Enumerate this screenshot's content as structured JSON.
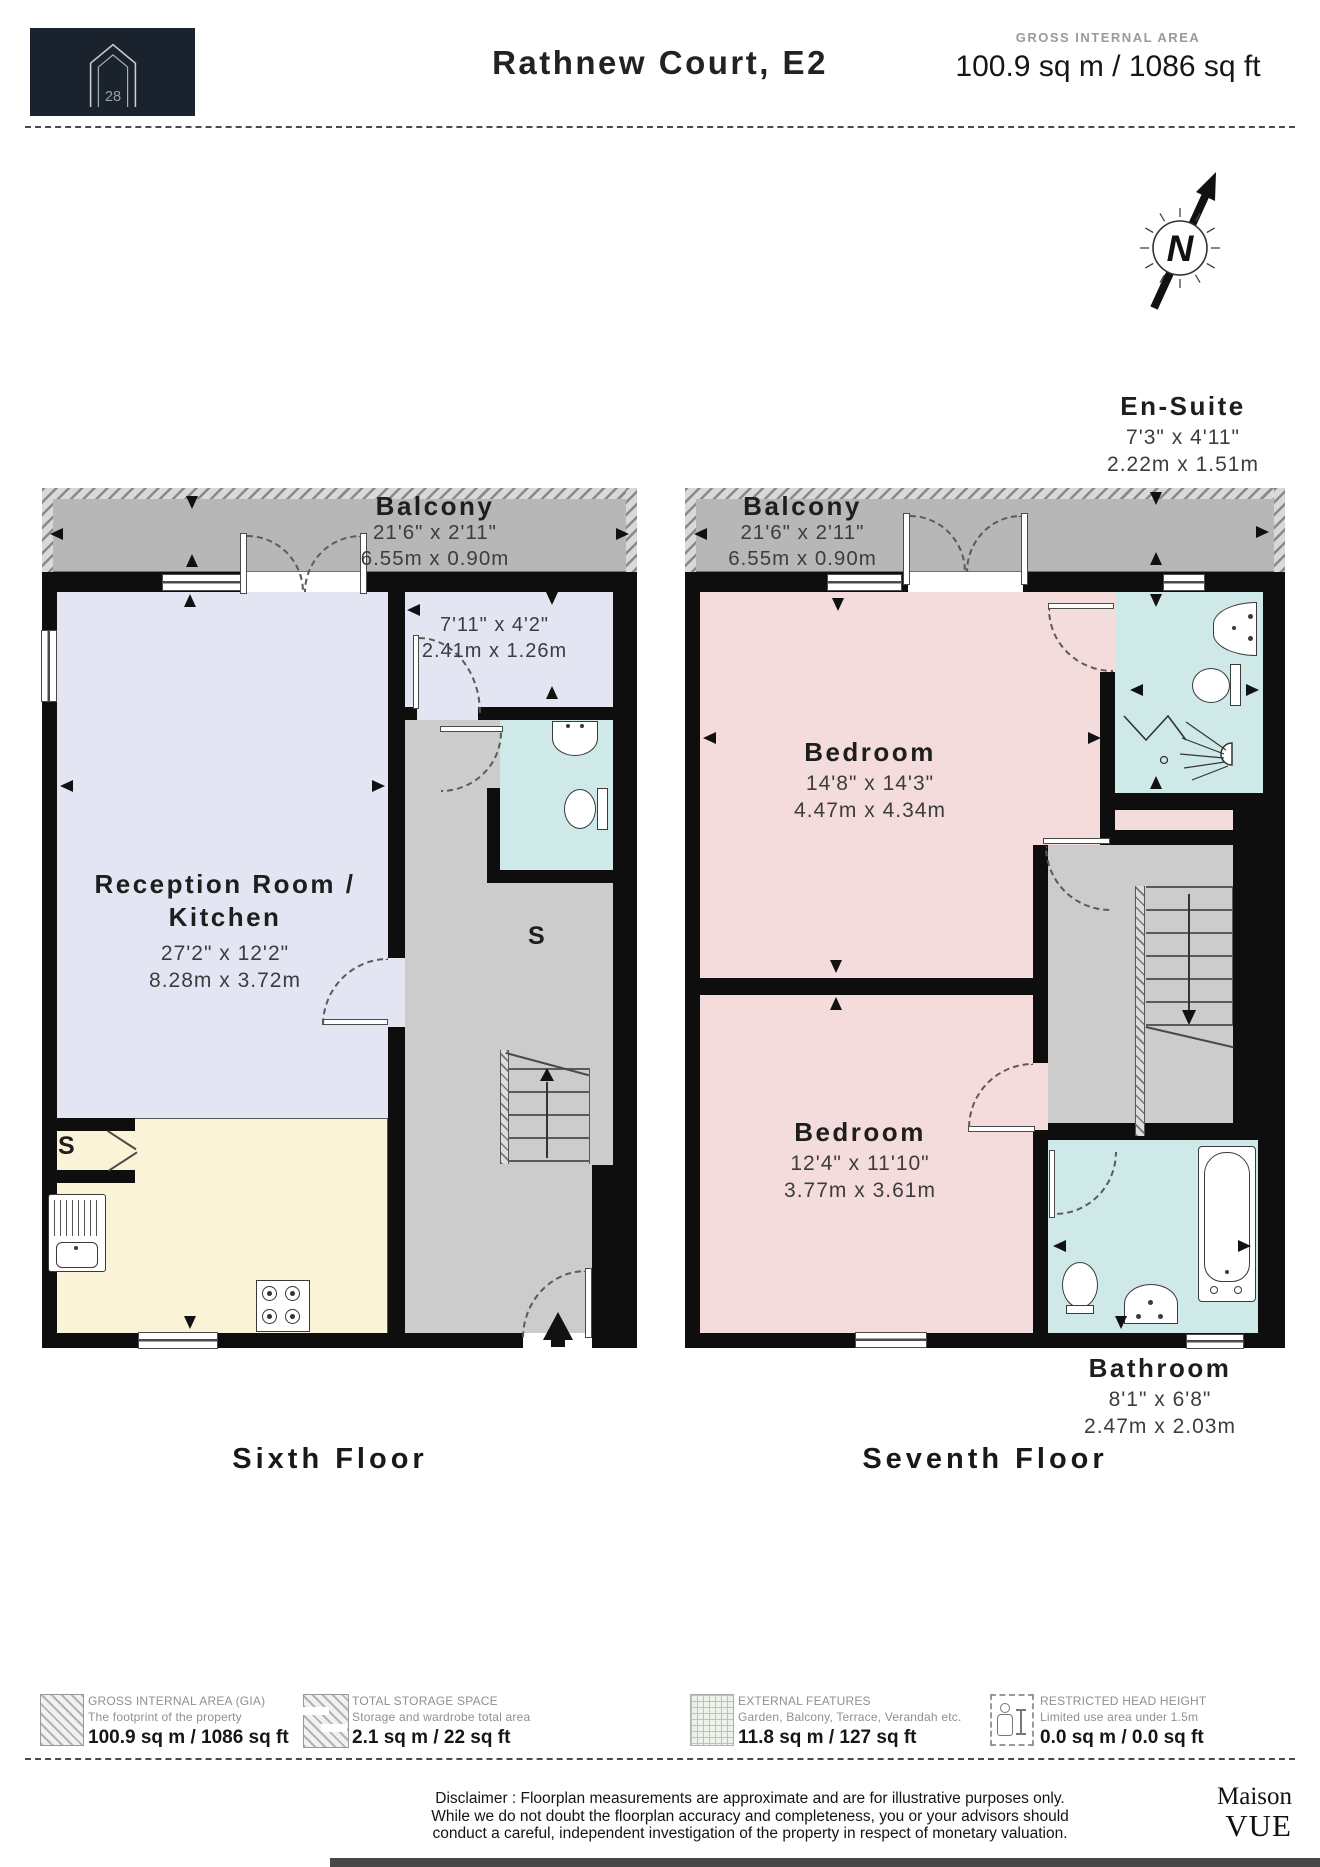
{
  "colors": {
    "wall": "#0e0e0e",
    "balcony": "#b7b7b7",
    "corridor": "#cccccc",
    "lavender": "#e3e5f3",
    "cream": "#faf3d8",
    "pink": "#f5dcdc",
    "bath_blue": "#cfe9e9",
    "logo_bg": "#1a222e"
  },
  "header": {
    "logo_number": "28",
    "title": "Rathnew Court, E2",
    "gia_label": "GROSS INTERNAL AREA",
    "gia_value": "100.9 sq m / 1086 sq ft"
  },
  "compass": {
    "n": "N"
  },
  "sixth": {
    "floor_label": "Sixth Floor",
    "balcony": {
      "name": "Balcony",
      "imperial": "21'6\" x 2'11\"",
      "metric": "6.55m x 0.90m"
    },
    "lobby": {
      "imperial": "7'11\" x 4'2\"",
      "metric": "2.41m x 1.26m"
    },
    "reception": {
      "name": "Reception Room / Kitchen",
      "imperial": "27'2\" x 12'2\"",
      "metric": "8.28m x 3.72m"
    },
    "storage_label": "S",
    "kitchen_storage_label": "S"
  },
  "seventh": {
    "floor_label": "Seventh Floor",
    "balcony": {
      "name": "Balcony",
      "imperial": "21'6\" x 2'11\"",
      "metric": "6.55m x 0.90m"
    },
    "ensuite": {
      "name": "En-Suite",
      "imperial": "7'3\" x 4'11\"",
      "metric": "2.22m x 1.51m"
    },
    "bedroom1": {
      "name": "Bedroom",
      "imperial": "14'8\" x 14'3\"",
      "metric": "4.47m x 4.34m"
    },
    "bedroom2": {
      "name": "Bedroom",
      "imperial": "12'4\" x 11'10\"",
      "metric": "3.77m x 3.61m"
    },
    "bathroom": {
      "name": "Bathroom",
      "imperial": "8'1\" x 6'8\"",
      "metric": "2.47m x 2.03m"
    }
  },
  "legend": {
    "items": [
      {
        "title": "GROSS INTERNAL AREA (GIA)",
        "subtitle": "The footprint of the property",
        "value": "100.9 sq m / 1086 sq ft"
      },
      {
        "title": "TOTAL STORAGE SPACE",
        "subtitle": "Storage and wardrobe total area",
        "value": "2.1 sq m / 22 sq ft"
      },
      {
        "title": "EXTERNAL FEATURES",
        "subtitle": "Garden, Balcony, Terrace, Verandah etc.",
        "value": "11.8 sq m / 127 sq ft"
      },
      {
        "title": "RESTRICTED HEAD HEIGHT",
        "subtitle": "Limited use area under 1.5m",
        "value": "0.0 sq m / 0.0 sq ft"
      }
    ]
  },
  "disclaimer": {
    "line1": "Disclaimer : Floorplan measurements are approximate and are for illustrative purposes only.",
    "line2": "While we do not doubt the floorplan accuracy and completeness, you or your advisors should",
    "line3": "conduct a careful, independent investigation of the property in respect of monetary valuation."
  },
  "brand": {
    "name": "Maison",
    "sub": "VUE"
  }
}
